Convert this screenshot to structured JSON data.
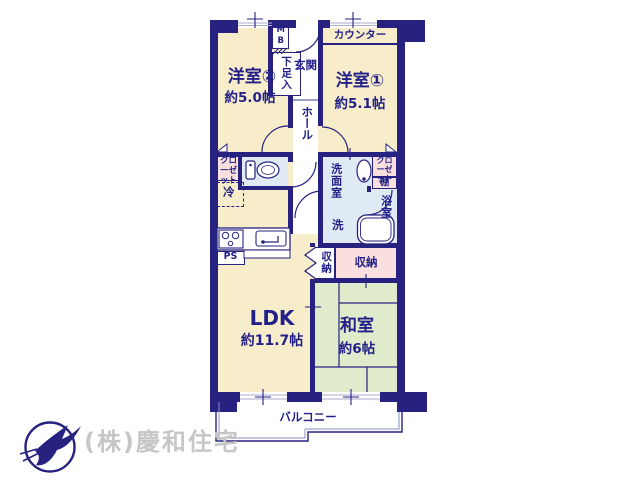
{
  "colors": {
    "wall": "#272280",
    "room_floor": "#f7edca",
    "tatami_floor": "#e0ebcc",
    "storage_pink": "#f9dfdd",
    "wet_area_blue": "#e0eaf5",
    "label_text": "#232189",
    "company_text": "#c6c6c6"
  },
  "plan": {
    "rooms": [
      {
        "name": "洋室②",
        "size": "約5.0帖"
      },
      {
        "name": "洋室①",
        "size": "約5.1帖"
      },
      {
        "name": "LDK",
        "size": "約11.7帖"
      },
      {
        "name": "和室",
        "size": "約6帖"
      }
    ],
    "labels": {
      "counter": "カウンター",
      "meter_box": "MB",
      "shoe_cabinet": "下足入",
      "entrance": "玄関",
      "hall": "ホール",
      "closet_left": "クローゼット",
      "refrigerator": "冷",
      "washroom": "洗面室",
      "washing_machine": "洗",
      "closet_right": "クローゼット",
      "shelf": "棚",
      "bathroom": "浴室",
      "storage_hall": "収納",
      "storage_washitsu": "収納",
      "pipe_space": "PS",
      "balcony": "バルコニー"
    },
    "icons": {
      "toilet": "toilet-icon",
      "washbasin": "washbasin-icon",
      "bathtub": "bathtub-icon",
      "stove": "stove-icon",
      "kitchen_sink": "kitchen-sink-icon",
      "doors": "door-swing-arc-icon",
      "logo": "bird-in-circle-icon"
    }
  },
  "footer": {
    "company": "(株)慶和住宅"
  }
}
